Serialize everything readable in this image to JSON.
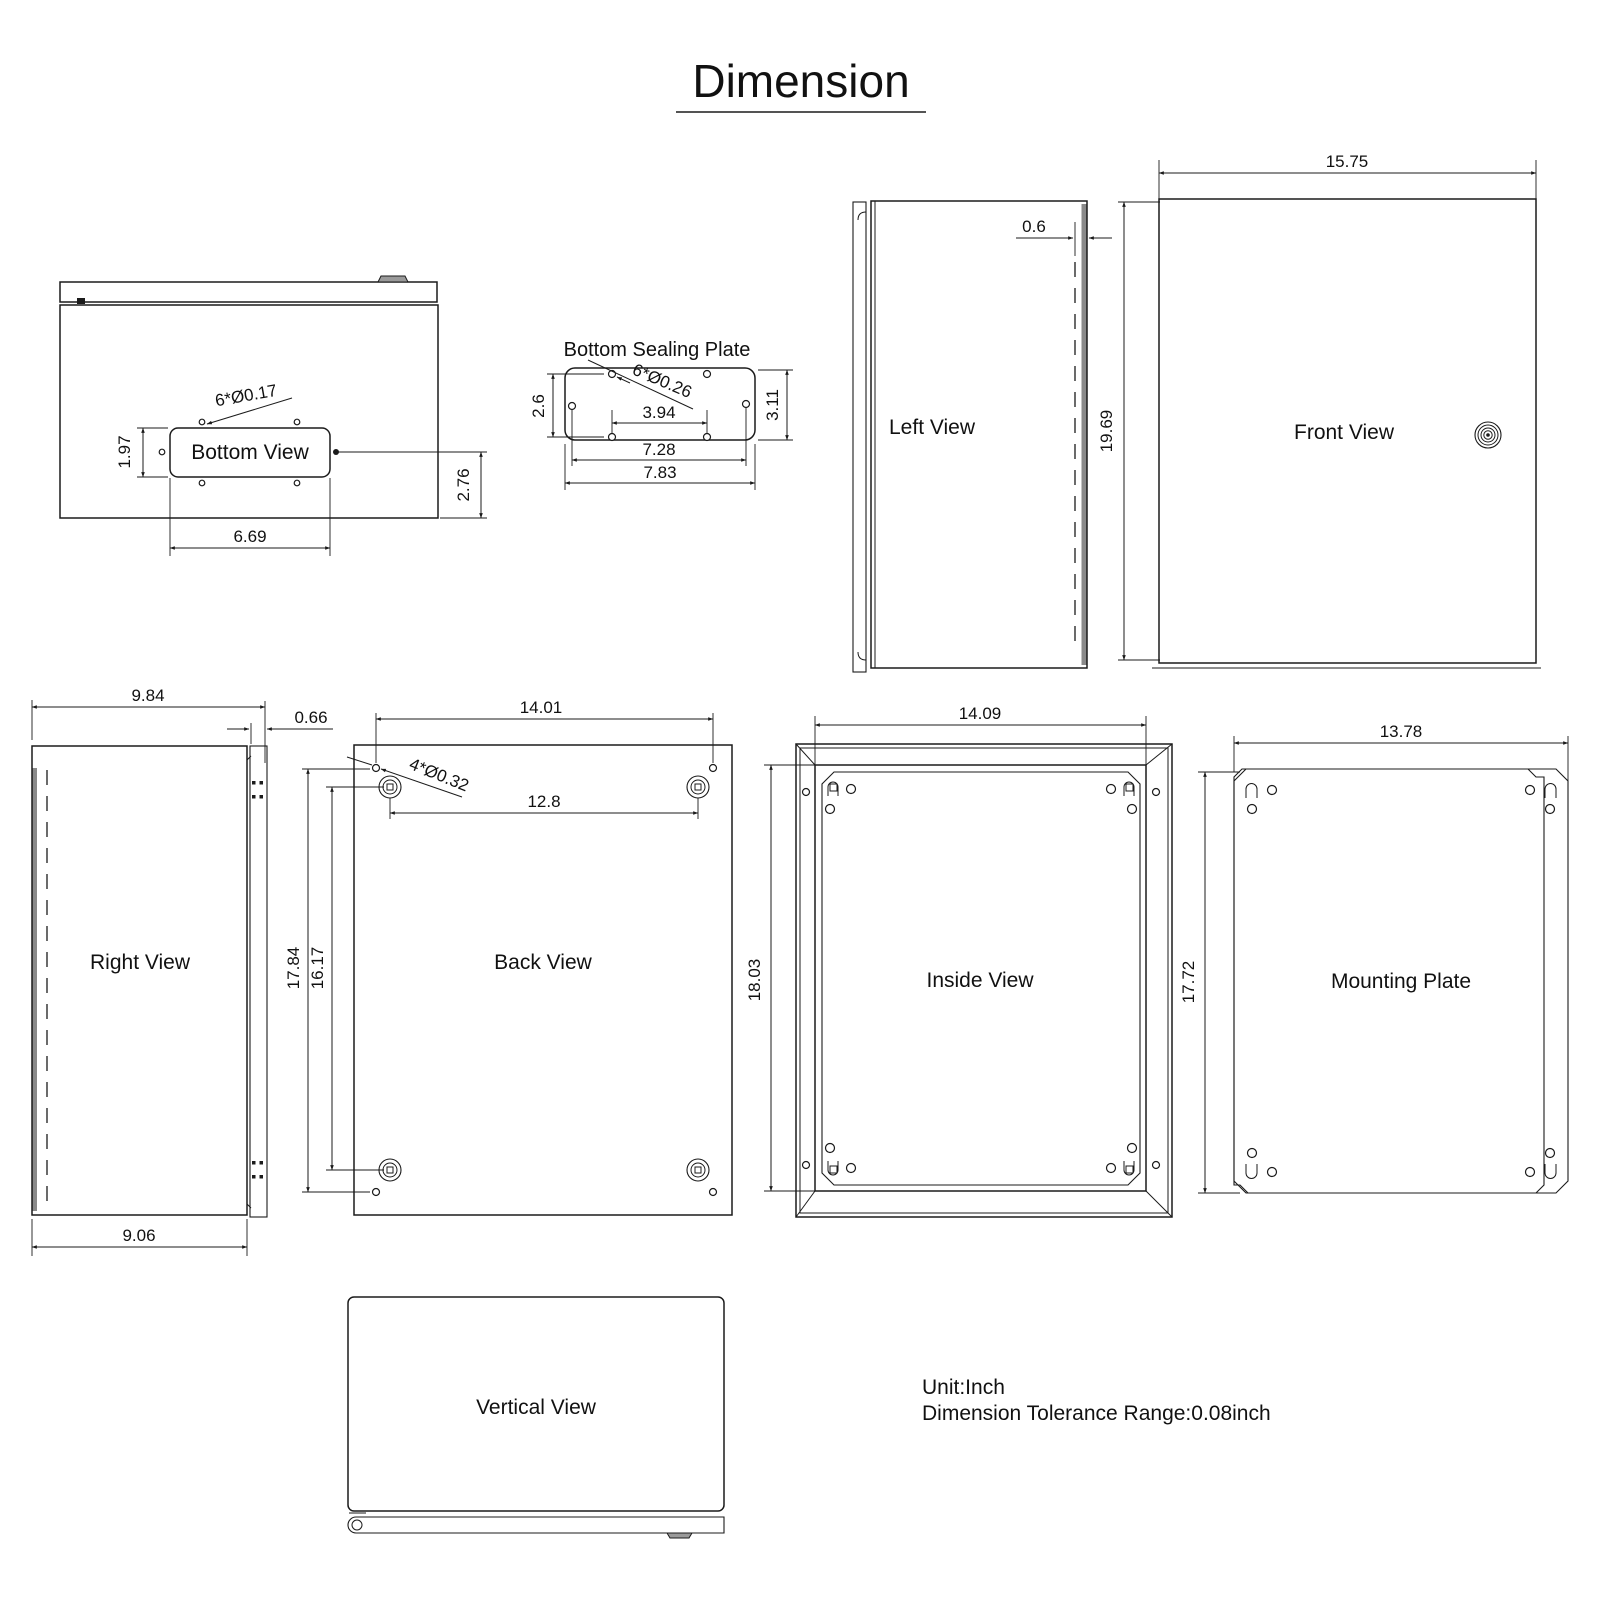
{
  "title": "Dimension",
  "colors": {
    "line": "#1b1b1b",
    "steel_gray": "#8a8a8a",
    "background": "#ffffff"
  },
  "footer": {
    "unit": "Unit:Inch",
    "tolerance": "Dimension Tolerance Range:0.08inch"
  },
  "views": {
    "bottom": {
      "label": "Bottom View",
      "dims": {
        "hole_callout": "6*Ø0.17",
        "cutout_offset": "1.97",
        "depth": "2.76",
        "cutout_width": "6.69"
      }
    },
    "bottom_sealing_plate": {
      "label": "Bottom Sealing Plate",
      "dims": {
        "hole_callout": "6*Ø0.26",
        "hole_rows_height": "2.6",
        "plate_height": "3.11",
        "inner_hole_span": "3.94",
        "mid_hole_span": "7.28",
        "plate_width": "7.83"
      }
    },
    "left": {
      "label": "Left View",
      "dims": {
        "door_offset": "0.6"
      }
    },
    "front": {
      "label": "Front View",
      "dims": {
        "width": "15.75",
        "height": "19.69"
      }
    },
    "right": {
      "label": "Right View",
      "dims": {
        "top_depth": "9.84",
        "door_thickness": "0.66",
        "body_depth": "9.06"
      }
    },
    "back": {
      "label": "Back View",
      "dims": {
        "hole_span_width": "14.01",
        "boss_span_width": "12.8",
        "hole_callout": "4*Ø0.32",
        "hole_span_height": "17.84",
        "boss_span_height": "16.17"
      }
    },
    "inside": {
      "label": "Inside View",
      "dims": {
        "opening_width": "14.09",
        "opening_height": "18.03"
      }
    },
    "mounting_plate": {
      "label": "Mounting Plate",
      "dims": {
        "width": "13.78",
        "height": "17.72"
      }
    },
    "vertical": {
      "label": "Vertical View"
    }
  }
}
